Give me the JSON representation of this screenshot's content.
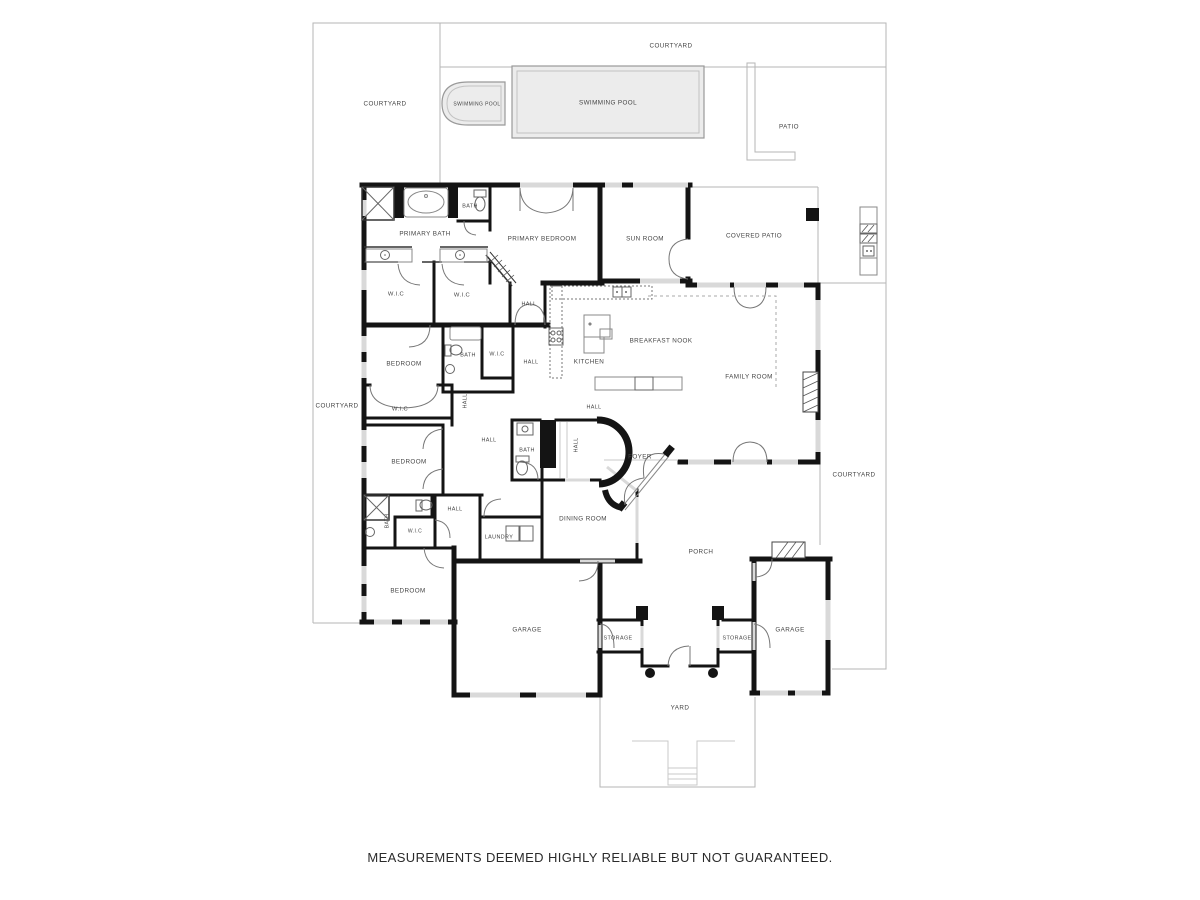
{
  "footer": {
    "disclaimer": "MEASUREMENTS DEEMED HIGHLY RELIABLE BUT NOT GUARANTEED."
  },
  "palette": {
    "wall": "#141414",
    "boundary": "#b5b5b5",
    "window": "#d9d9d9",
    "fixture": "#888888",
    "pool_fill": "#ececec",
    "label": "#444444"
  },
  "labels": [
    {
      "id": "courtyard-top",
      "text": "COURTYARD",
      "x": 671,
      "y": 46
    },
    {
      "id": "courtyard-upper-left",
      "text": "COURTYARD",
      "x": 385,
      "y": 104
    },
    {
      "id": "swimming-pool-spa",
      "text": "SWIMMING POOL",
      "x": 477,
      "y": 104,
      "size": 5.0
    },
    {
      "id": "swimming-pool",
      "text": "SWIMMING POOL",
      "x": 608,
      "y": 103
    },
    {
      "id": "patio",
      "text": "PATIO",
      "x": 789,
      "y": 127
    },
    {
      "id": "primary-bath",
      "text": "PRIMARY BATH",
      "x": 425,
      "y": 234
    },
    {
      "id": "bath-top",
      "text": "BATH",
      "x": 470,
      "y": 206,
      "size": 5.4
    },
    {
      "id": "primary-bedroom",
      "text": "PRIMARY BEDROOM",
      "x": 542,
      "y": 239
    },
    {
      "id": "sun-room",
      "text": "SUN ROOM",
      "x": 645,
      "y": 239
    },
    {
      "id": "covered-patio",
      "text": "COVERED PATIO",
      "x": 754,
      "y": 236
    },
    {
      "id": "wic-1",
      "text": "W.I.C",
      "x": 396,
      "y": 294,
      "size": 5.8
    },
    {
      "id": "wic-2",
      "text": "W.I.C",
      "x": 462,
      "y": 295,
      "size": 5.8
    },
    {
      "id": "hall-north",
      "text": "HALL",
      "x": 529,
      "y": 304,
      "size": 5.4
    },
    {
      "id": "breakfast-nook",
      "text": "BREAKFAST NOOK",
      "x": 661,
      "y": 341
    },
    {
      "id": "kitchen",
      "text": "KITCHEN",
      "x": 589,
      "y": 362
    },
    {
      "id": "family-room",
      "text": "FAMILY ROOM",
      "x": 749,
      "y": 377
    },
    {
      "id": "bedroom-1",
      "text": "BEDROOM",
      "x": 404,
      "y": 364
    },
    {
      "id": "bath-1",
      "text": "BATH",
      "x": 468,
      "y": 355,
      "size": 5.4
    },
    {
      "id": "wic-3",
      "text": "W.I.C",
      "x": 497,
      "y": 354,
      "size": 5.4
    },
    {
      "id": "hall-south",
      "text": "HALL",
      "x": 531,
      "y": 362,
      "size": 5.4
    },
    {
      "id": "wic-4",
      "text": "W.I.C",
      "x": 400,
      "y": 409,
      "size": 5.8
    },
    {
      "id": "hall-vertical",
      "text": "HALL",
      "x": 465,
      "y": 401,
      "rotate": -90,
      "size": 5.4
    },
    {
      "id": "hall-kitchen",
      "text": "HALL",
      "x": 594,
      "y": 407,
      "size": 5.4
    },
    {
      "id": "hall-center",
      "text": "HALL",
      "x": 489,
      "y": 440,
      "size": 5.4
    },
    {
      "id": "bath-2",
      "text": "BATH",
      "x": 527,
      "y": 450,
      "size": 5.4
    },
    {
      "id": "hall-east",
      "text": "HALL",
      "x": 576,
      "y": 445,
      "rotate": -90,
      "size": 5.4
    },
    {
      "id": "foyer",
      "text": "FOYER",
      "x": 640,
      "y": 457
    },
    {
      "id": "bedroom-2",
      "text": "BEDROOM",
      "x": 409,
      "y": 462
    },
    {
      "id": "dining-room",
      "text": "DINING ROOM",
      "x": 583,
      "y": 519
    },
    {
      "id": "porch",
      "text": "PORCH",
      "x": 701,
      "y": 552
    },
    {
      "id": "bath-3",
      "text": "BATH",
      "x": 387,
      "y": 521,
      "rotate": -90,
      "size": 5.0
    },
    {
      "id": "wic-5",
      "text": "W.I.C",
      "x": 415,
      "y": 531,
      "size": 5.0
    },
    {
      "id": "hall-bottom",
      "text": "HALL",
      "x": 455,
      "y": 509,
      "size": 5.4
    },
    {
      "id": "laundry",
      "text": "LAUNDRY",
      "x": 499,
      "y": 537,
      "size": 5.4
    },
    {
      "id": "bedroom-3",
      "text": "BEDROOM",
      "x": 408,
      "y": 591
    },
    {
      "id": "garage-left",
      "text": "GARAGE",
      "x": 527,
      "y": 630
    },
    {
      "id": "storage-left",
      "text": "STORAGE",
      "x": 618,
      "y": 638,
      "size": 5.4
    },
    {
      "id": "storage-right",
      "text": "STORAGE",
      "x": 737,
      "y": 638,
      "size": 5.4
    },
    {
      "id": "garage-right",
      "text": "GARAGE",
      "x": 790,
      "y": 630
    },
    {
      "id": "yard",
      "text": "YARD",
      "x": 680,
      "y": 708
    },
    {
      "id": "courtyard-left",
      "text": "COURTYARD",
      "x": 337,
      "y": 406
    },
    {
      "id": "courtyard-right",
      "text": "COURTYARD",
      "x": 854,
      "y": 475
    }
  ]
}
